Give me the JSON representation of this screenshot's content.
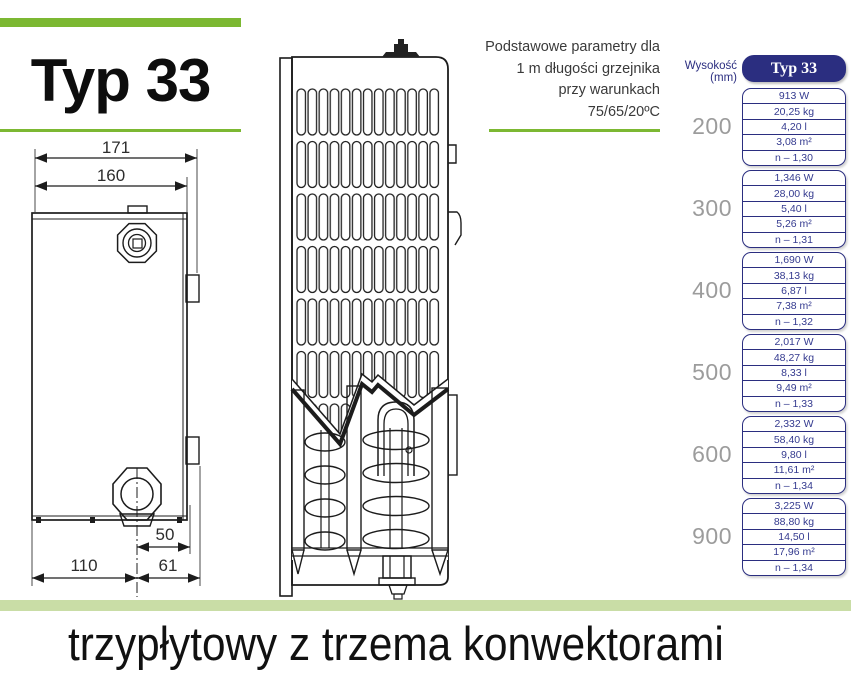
{
  "header": {
    "title": "Typ 33"
  },
  "note": {
    "lines": [
      "Podstawowe parametry dla",
      "1 m długości grzejnika",
      "przy warunkach",
      "75/65/20ºC"
    ]
  },
  "side_view_dimensions": {
    "total_width": "171",
    "body_width": "160",
    "valve_offset": "50",
    "left_span": "110",
    "right_span": "61"
  },
  "table": {
    "axis_label": "Wysokość (mm)",
    "column_header": "Typ 33",
    "rows": [
      {
        "height": "200",
        "values": [
          "913 W",
          "20,25 kg",
          "4,20 l",
          "3,08 m²",
          "n – 1,30"
        ]
      },
      {
        "height": "300",
        "values": [
          "1,346 W",
          "28,00 kg",
          "5,40 l",
          "5,26 m²",
          "n – 1,31"
        ]
      },
      {
        "height": "400",
        "values": [
          "1,690 W",
          "38,13 kg",
          "6,87 l",
          "7,38 m²",
          "n – 1,32"
        ]
      },
      {
        "height": "500",
        "values": [
          "2,017 W",
          "48,27 kg",
          "8,33 l",
          "9,49 m²",
          "n – 1,33"
        ]
      },
      {
        "height": "600",
        "values": [
          "2,332 W",
          "58,40 kg",
          "9,80 l",
          "11,61 m²",
          "n – 1,34"
        ]
      },
      {
        "height": "900",
        "values": [
          "3,225 W",
          "88,80 kg",
          "14,50 l",
          "17,96 m²",
          "n – 1,34"
        ]
      }
    ]
  },
  "footer": {
    "caption": "trzypłytowy z trzema konwektorami"
  },
  "colors": {
    "accent_green": "#7cb832",
    "light_green": "#c9dda6",
    "navy": "#2b2e80",
    "gray_height_label": "#9c9c9c"
  }
}
